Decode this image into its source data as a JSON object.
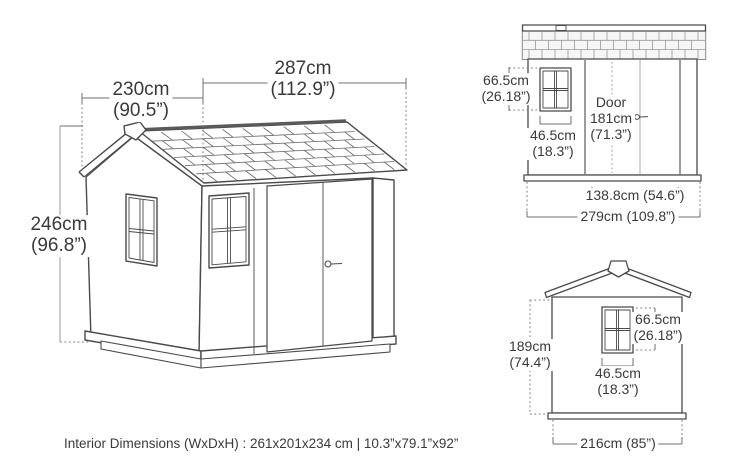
{
  "page": {
    "background": "#ffffff",
    "line_color": "#4a4a4a",
    "text_color": "#3a3a3a",
    "dotted_color": "#7a7a7a"
  },
  "main_view": {
    "description": "3D perspective drawing of shed",
    "width_label": {
      "value": "287cm",
      "imperial": "(112.9”)"
    },
    "depth_label": {
      "value": "230cm",
      "imperial": "(90.5”)"
    },
    "height_label": {
      "value": "246cm",
      "imperial": "(96.8”)"
    }
  },
  "front_elevation": {
    "description": "Front elevation with door",
    "window_height": {
      "value": "66.5cm",
      "imperial": "(26.18”)"
    },
    "window_width": {
      "value": "46.5cm",
      "imperial": "(18.3”)"
    },
    "door_label": {
      "line1": "Door",
      "line2": "181cm",
      "line3": "(71.3”)"
    },
    "door_width": "138.8cm (54.6”)",
    "total_width": "279cm (109.8”)"
  },
  "side_elevation": {
    "description": "Side (gable) elevation",
    "wall_height": {
      "value": "189cm",
      "imperial": "(74.4”)"
    },
    "window_height": {
      "value": "66.5cm",
      "imperial": "(26.18”)"
    },
    "window_width": {
      "value": "46.5cm",
      "imperial": "(18.3”)"
    },
    "total_width": "216cm (85”)"
  },
  "footer": {
    "interior_dimensions": "Interior Dimensions (WxDxH) : 261x201x234 cm | 10.3”x79.1”x92”"
  }
}
